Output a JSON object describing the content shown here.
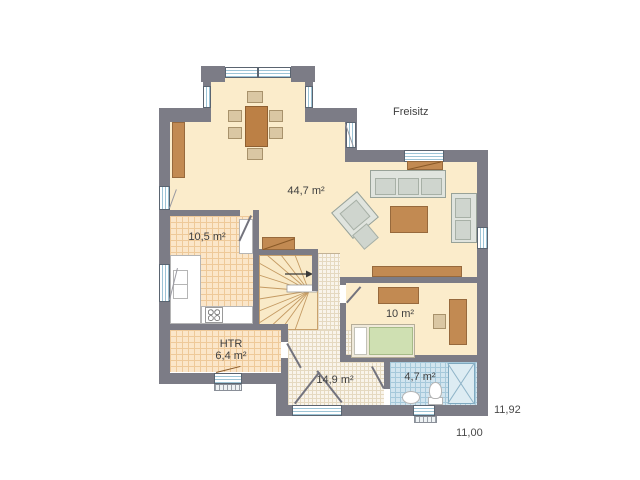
{
  "plan": {
    "outdoor_label": "Freisitz",
    "dimensions": {
      "upper": "11,92",
      "lower": "11,00"
    },
    "rooms": [
      {
        "id": "living_dining",
        "area_label": "44,7 m²"
      },
      {
        "id": "kitchen",
        "area_label": "10,5 m²"
      },
      {
        "id": "bedroom",
        "area_label": "10 m²"
      },
      {
        "id": "htr",
        "name_label": "HTR",
        "area_label": "6,4 m²"
      },
      {
        "id": "hall",
        "area_label": "14,9 m²"
      },
      {
        "id": "bath",
        "area_label": "4,7 m²"
      }
    ],
    "colors": {
      "wall": "#7c7c86",
      "floor": "#fbeccb",
      "kitchen_tile": "#fbe6c9",
      "hall_tile": "#f9f4ea",
      "bath_tile": "#d2e5ef",
      "furniture_brown": "#c28a52",
      "sofa_gray": "#cfd5ce",
      "bed_green": "#cfe0b2",
      "window_glass": "#eaf4f8",
      "label_text": "#3f3f3f"
    }
  }
}
